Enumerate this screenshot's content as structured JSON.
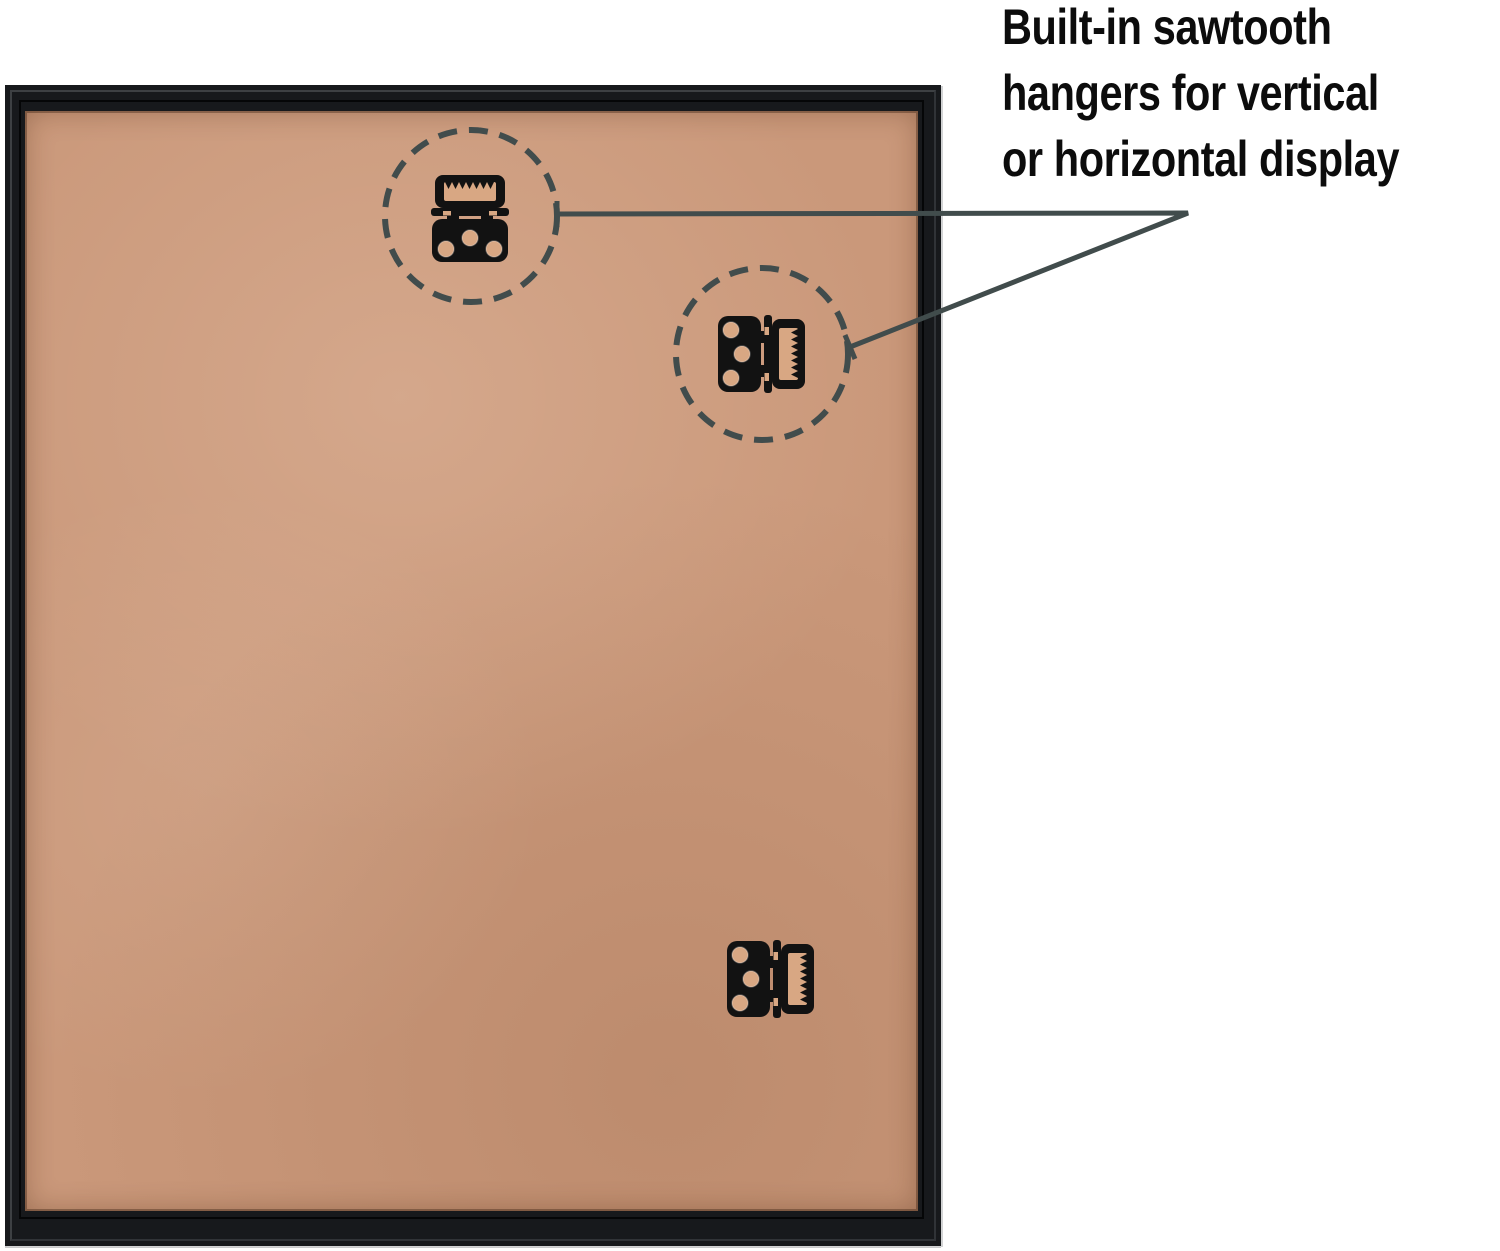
{
  "caption": {
    "text": "Built-in sawtooth\nhangers for vertical\nor horizontal display"
  },
  "scene": {
    "subject": "back of a black picture frame with tan MDF backing board",
    "hangers": [
      {
        "position": "upper-left",
        "orientation": "horizontal",
        "circled": true
      },
      {
        "position": "upper-middle",
        "orientation": "vertical",
        "circled": true
      },
      {
        "position": "lower-middle",
        "orientation": "vertical",
        "circled": false
      }
    ]
  },
  "icons": [
    "sawtooth-hanger-icon",
    "dashed-highlight-circle",
    "callout-line"
  ],
  "colors": {
    "background": "#ffffff",
    "ink": "#0c0c0c",
    "frame": "#17191c",
    "backing": "#ca987a",
    "hole": "#d8a783",
    "metal": "#121212",
    "callout": "#414c4c"
  }
}
